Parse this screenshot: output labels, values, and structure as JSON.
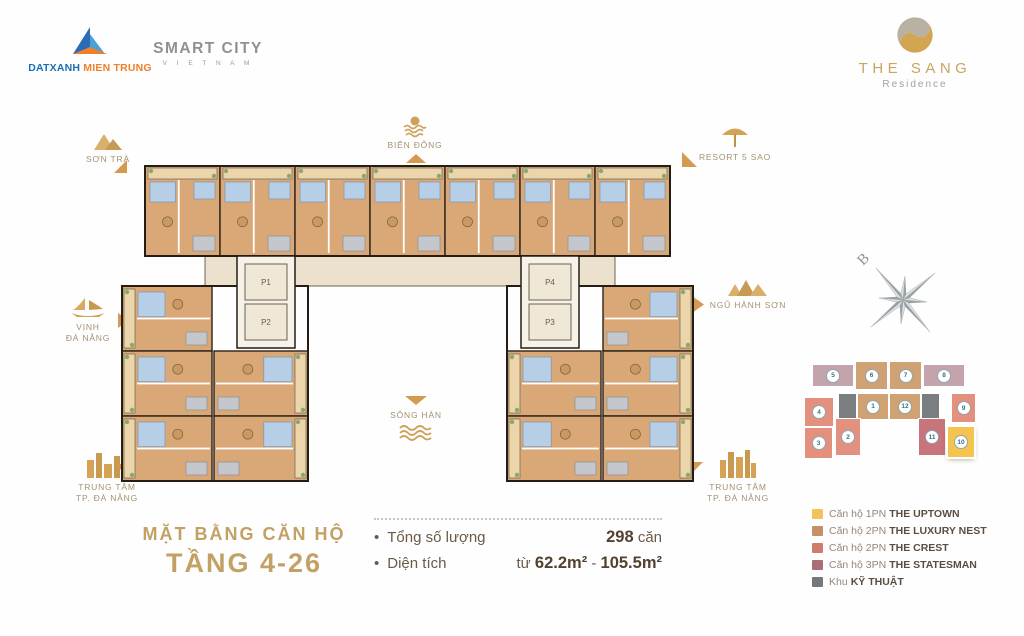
{
  "header": {
    "datxanh": {
      "name1": "DATXANH",
      "name2": "MIEN TRUNG"
    },
    "smartcity": {
      "line1": "SMART CITY",
      "line2": "V I E T N A M"
    },
    "thesang": {
      "brand": "THE SANG",
      "sub": "Residence"
    }
  },
  "landmarks": {
    "son_tra": "SƠN TRÀ",
    "bien_dong": "BIỂN ĐÔNG",
    "resort": "RESORT 5 SAO",
    "vinh": [
      "VỊNH",
      "ĐÀ NẴNG"
    ],
    "ngu_hanh_son": "NGŨ HÀNH SƠN",
    "song_han": "SÔNG HÀN",
    "center_sw": [
      "TRUNG TÂM",
      "TP. ĐÀ NẴNG"
    ],
    "center_se": [
      "TRUNG TÂM",
      "TP. ĐÀ NẴNG"
    ]
  },
  "compass": {
    "north": "B"
  },
  "plan": {
    "elevators": [
      "P1",
      "P2",
      "P3",
      "P4"
    ],
    "colors": {
      "floor": "#d9a876",
      "balcony": "#ecd4ab",
      "bed": "#b6cee6",
      "bath": "#c3c7cb",
      "corridor": "#ece1cd",
      "wall": "#2b2118",
      "core": "#f6f2e8",
      "plant": "#8aa86a",
      "elevbox": "#efe8d6"
    }
  },
  "key_plan": {
    "colors": {
      "uptown": "#f5c44e",
      "nest": "#cfa173",
      "crest": "#e3917e",
      "statesman": "#c8747b",
      "statesman_light": "#c3a3ac",
      "tech": "#7b7e81"
    },
    "units": [
      {
        "n": "5",
        "type": "statesman_light"
      },
      {
        "n": "6",
        "type": "nest"
      },
      {
        "n": "7",
        "type": "nest"
      },
      {
        "n": "8",
        "type": "statesman_light"
      },
      {
        "n": "4",
        "type": "crest"
      },
      {
        "n": "",
        "id": "t1",
        "type": "tech"
      },
      {
        "n": "1",
        "type": "nest"
      },
      {
        "n": "12",
        "type": "nest"
      },
      {
        "n": "",
        "id": "t2",
        "type": "tech"
      },
      {
        "n": "9",
        "type": "crest"
      },
      {
        "n": "3",
        "type": "crest"
      },
      {
        "n": "2",
        "type": "crest"
      },
      {
        "n": "11",
        "type": "statesman"
      },
      {
        "n": "10",
        "type": "uptown",
        "highlight": true
      }
    ]
  },
  "title": {
    "line1": "MẶT BẰNG CĂN HỘ",
    "line2": "TẦNG 4-26"
  },
  "stats": {
    "quantity": {
      "label": "Tổng số lượng",
      "value": "298",
      "unit": "căn"
    },
    "area": {
      "label": "Diện tích",
      "prefix": "từ",
      "v1": "62.2m²",
      "sep": "-",
      "v2": "105.5m²"
    }
  },
  "legend": {
    "items": [
      {
        "prefix": "Căn hộ 1PN",
        "name": "THE UPTOWN",
        "color": "#f2c35c"
      },
      {
        "prefix": "Căn hộ 2PN",
        "name": "THE LUXURY NEST",
        "color": "#c69067"
      },
      {
        "prefix": "Căn hộ 2PN",
        "name": "THE CREST",
        "color": "#cd7e6b"
      },
      {
        "prefix": "Căn hộ 3PN",
        "name": "THE STATESMAN",
        "color": "#aa6e76"
      },
      {
        "prefix": "Khu",
        "name": "KỸ THUẬT",
        "color": "#75787b"
      }
    ]
  }
}
